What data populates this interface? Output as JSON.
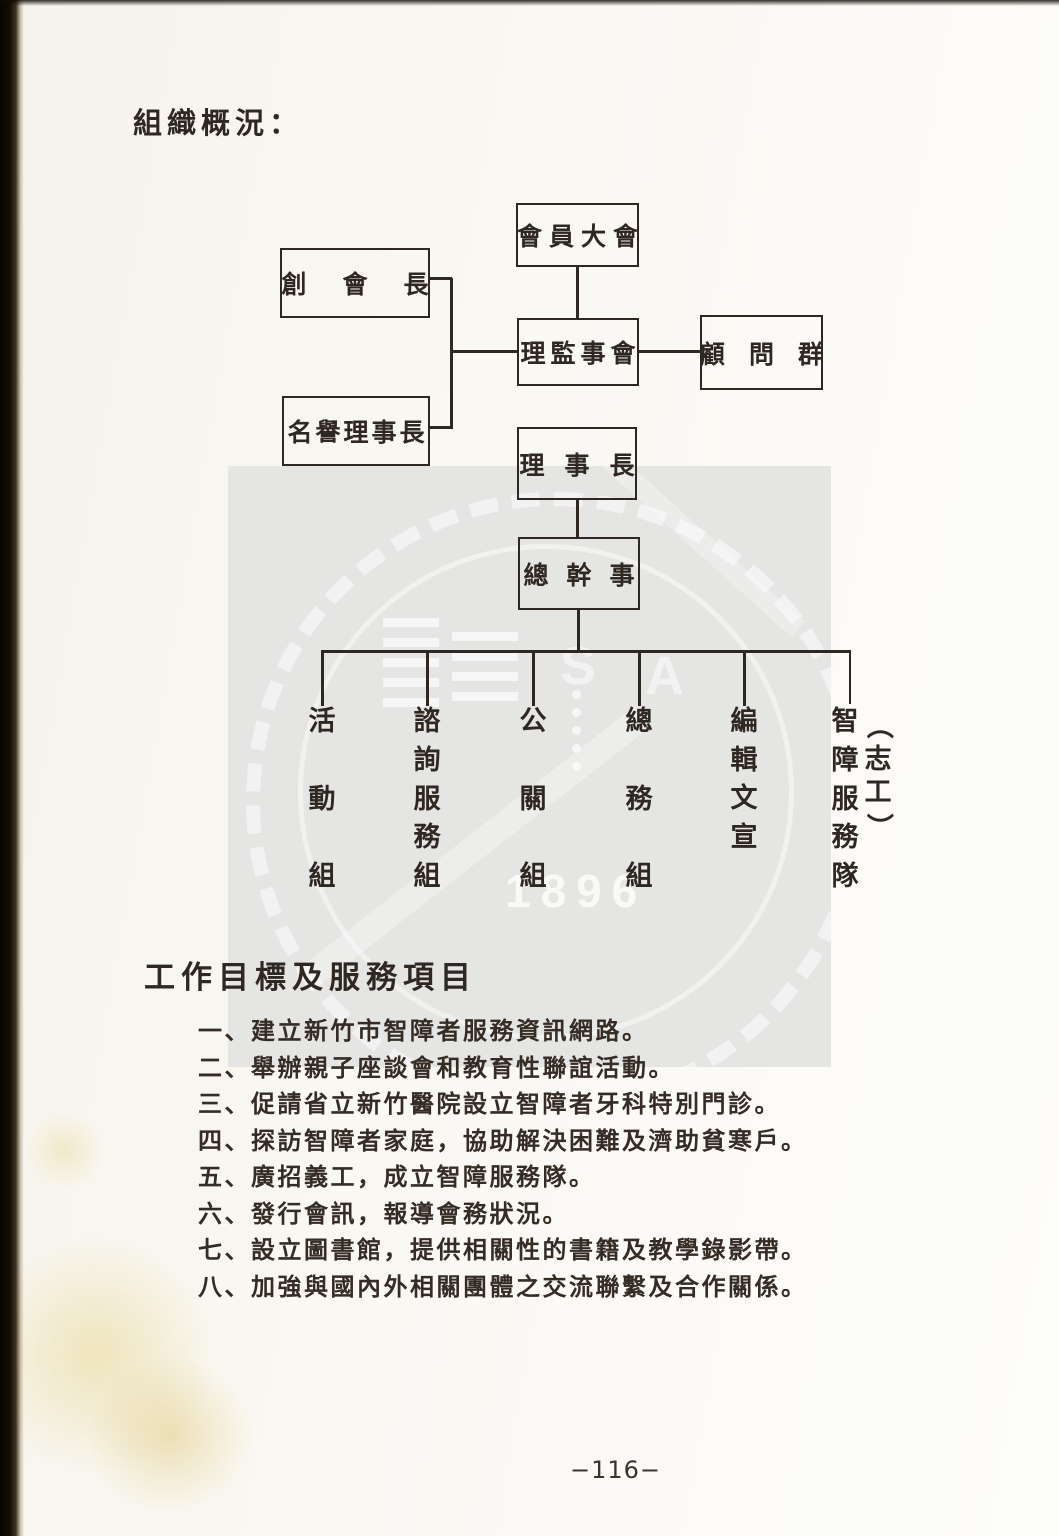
{
  "page": {
    "title": "組織概況：",
    "footer_page_number": "−116−"
  },
  "org_chart": {
    "boxes": [
      {
        "label": "會員大會"
      },
      {
        "label": "創會長"
      },
      {
        "label": "理監事會"
      },
      {
        "label": "顧問群"
      },
      {
        "label": "名譽理事長"
      },
      {
        "label": "理事長"
      },
      {
        "label": "總幹事"
      }
    ],
    "departments": [
      {
        "label": "活動組"
      },
      {
        "label": "諮詢服務組"
      },
      {
        "label": "公關組"
      },
      {
        "label": "總務組"
      },
      {
        "label": "編輯文宣"
      },
      {
        "label": "智障服務隊",
        "annotation": "（志工）"
      }
    ]
  },
  "goals": {
    "title": "工作目標及服務項目",
    "items": [
      "一、建立新竹市智障者服務資訊網路。",
      "二、舉辦親子座談會和教育性聯誼活動。",
      "三、促請省立新竹醫院設立智障者牙科特別門診。",
      "四、探訪智障者家庭，協助解決困難及濟助貧寒戶。",
      "五、廣招義工，成立智障服務隊。",
      "六、發行會訊，報導會務狀況。",
      "七、設立圖書館，提供相關性的書籍及教學錄影帶。",
      "八、加強與國內外相關團體之交流聯繫及合作關係。"
    ]
  },
  "watermark": {
    "emboss_letters": [
      "S",
      "A"
    ],
    "emboss_year": "1896"
  }
}
